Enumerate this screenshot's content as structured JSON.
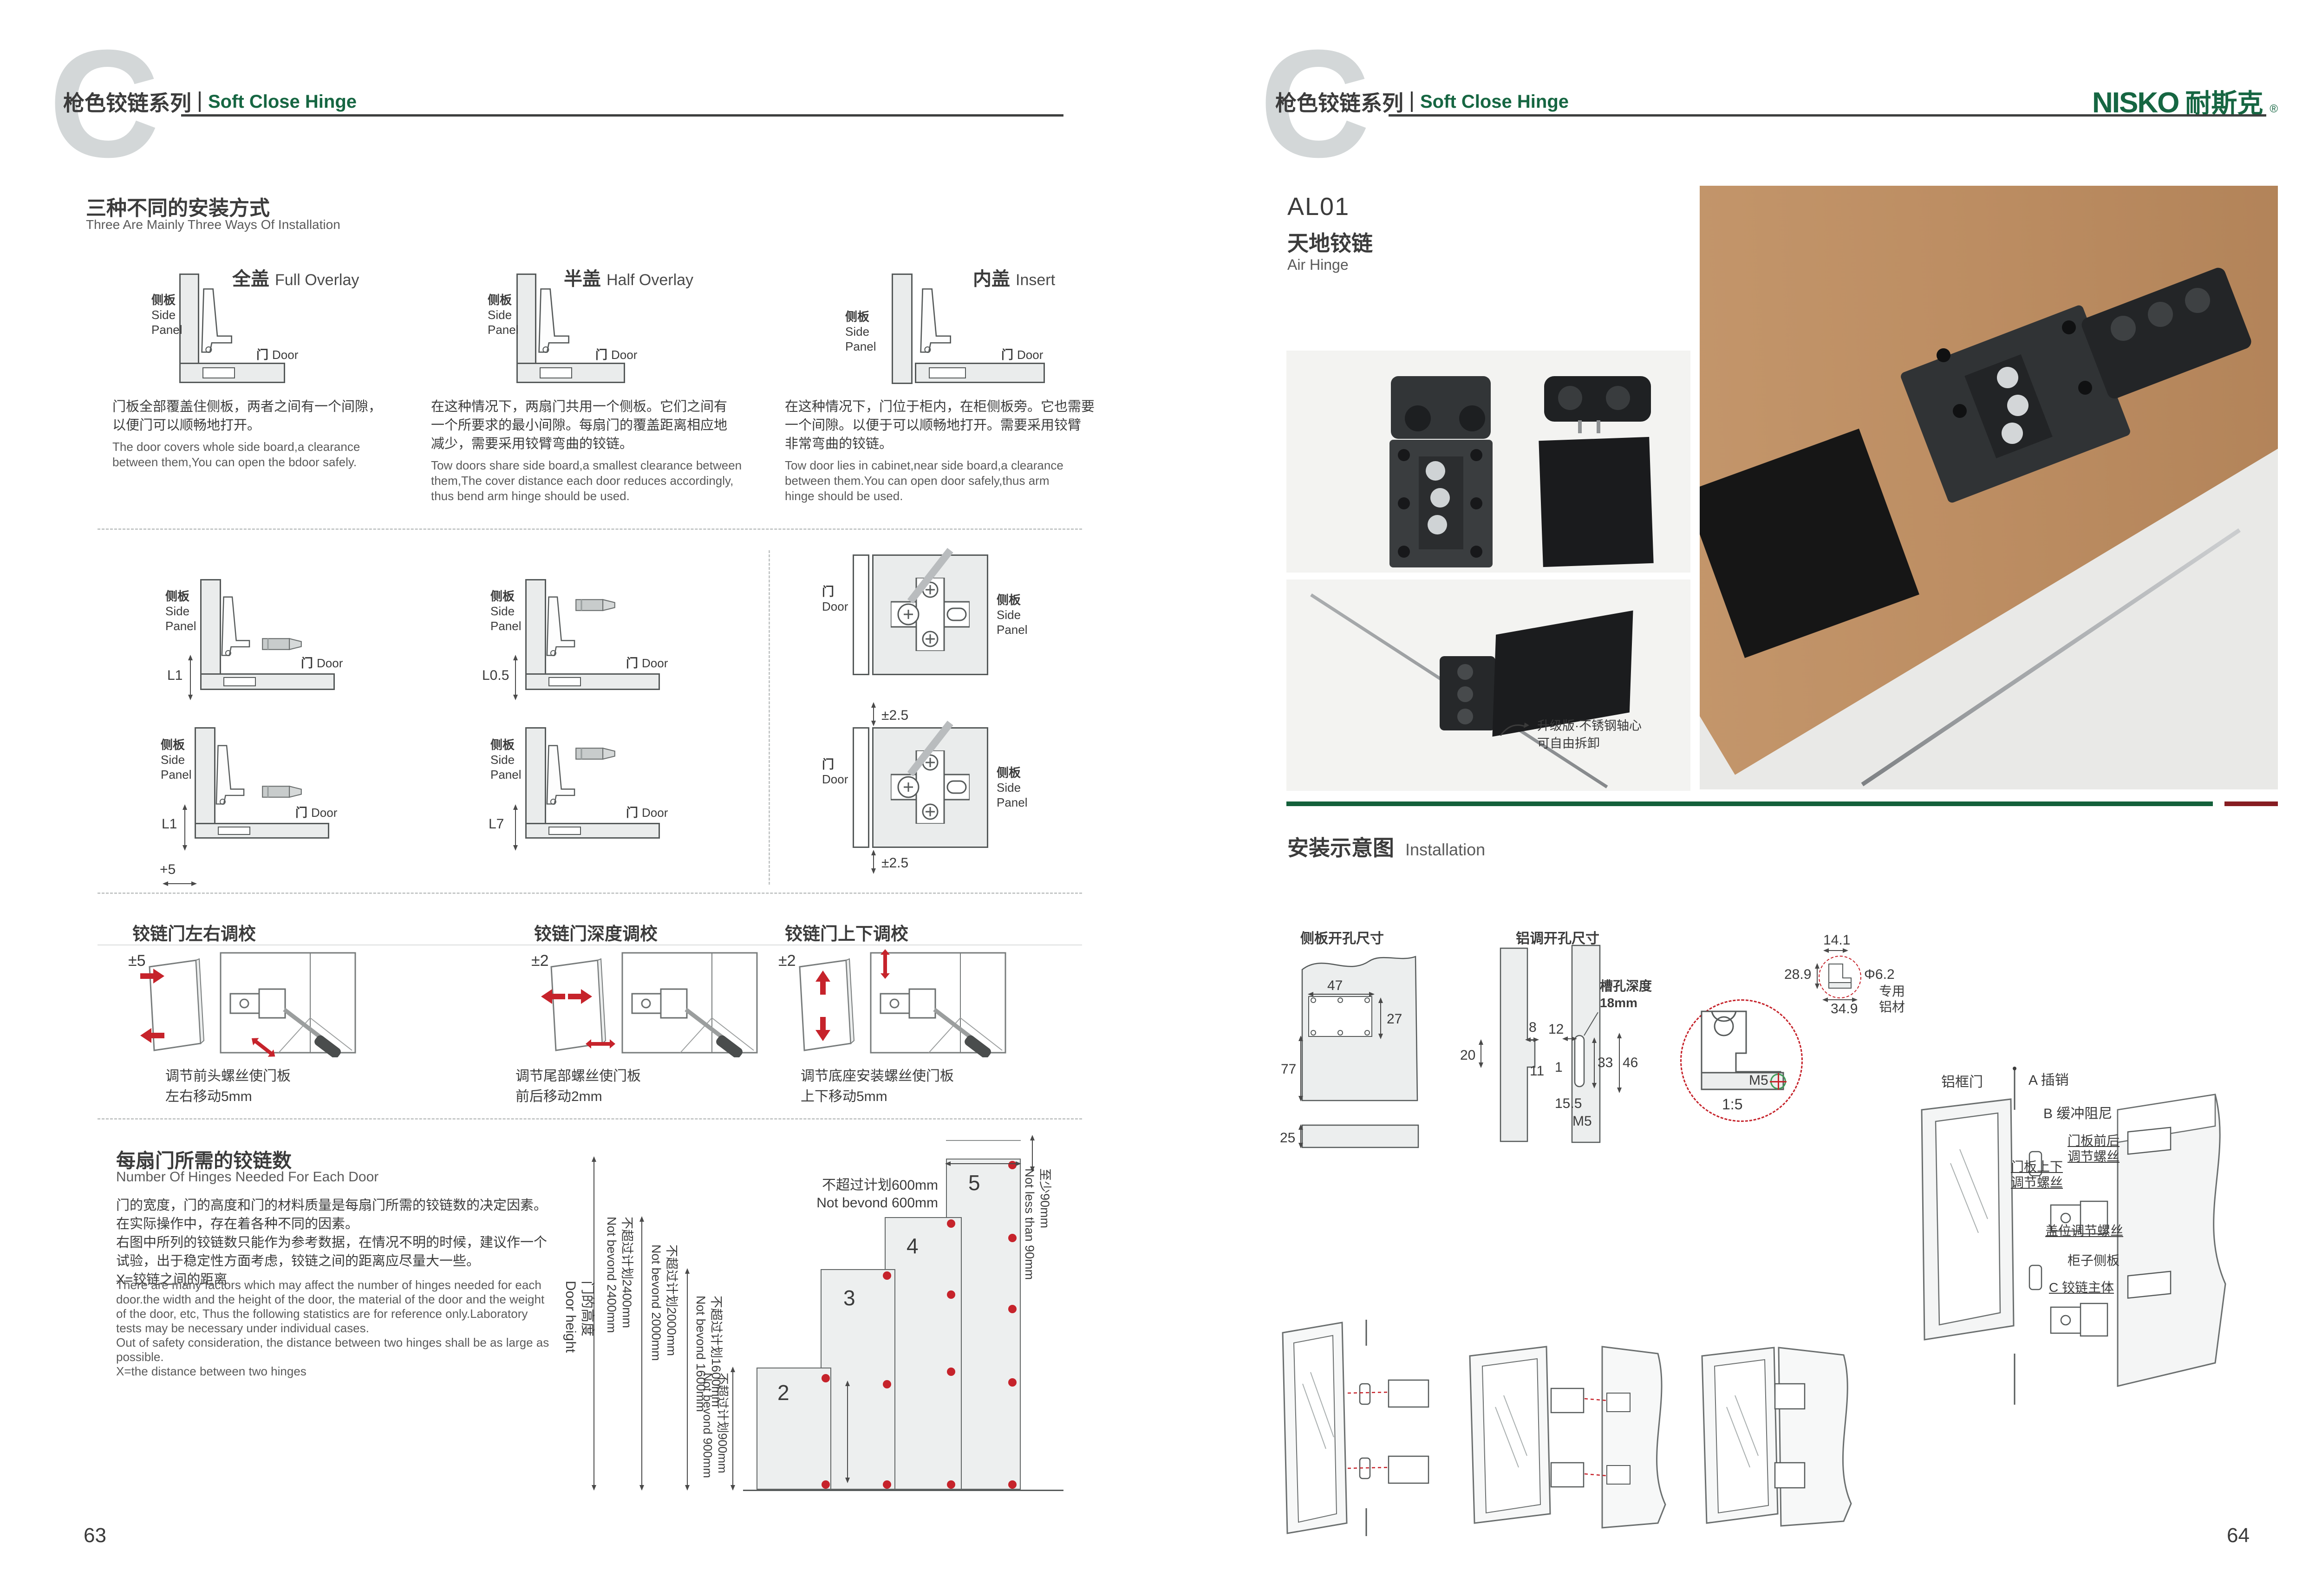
{
  "header": {
    "watermark": "C",
    "series_cn": "枪色铰链系列",
    "series_en": "Soft Close Hinge"
  },
  "brand": {
    "name": "NISKO",
    "cn": "耐斯克",
    "reg": "®"
  },
  "pages": {
    "left_no": "63",
    "right_no": "64"
  },
  "labels": {
    "side_panel_cn": "侧板",
    "side_panel_en1": "Side",
    "side_panel_en2": "Panel",
    "door_cn": "门",
    "door_en": "Door"
  },
  "install_ways": {
    "title_cn": "三种不同的安装方式",
    "title_en": "Three Are Mainly Three Ways Of Installation",
    "items": [
      {
        "name_cn": "全盖",
        "name_en": "Full Overlay",
        "desc_cn": "门板全部覆盖住侧板，两者之间有一个间隙，\n以便门可以顺畅地打开。",
        "desc_en": "The door covers whole side board,a clearance\nbetween them,You can open the bdoor safely."
      },
      {
        "name_cn": "半盖",
        "name_en": "Half Overlay",
        "desc_cn": "在这种情况下，两扇门共用一个侧板。它们之间有\n一个所要求的最小间隙。每扇门的覆盖距离相应地\n减少，需要采用铰臂弯曲的铰链。",
        "desc_en": "Tow doors share side board,a smallest clearance between\nthem,The cover distance each door reduces accordingly,\nthus bend arm hinge should be used."
      },
      {
        "name_cn": "内盖",
        "name_en": "Insert",
        "desc_cn": "在这种情况下，门位于柜内，在柜侧板旁。它也需要\n一个间隙。以便于可以顺畅地打开。需要采用铰臂\n非常弯曲的铰链。",
        "desc_en": "Tow door lies in cabinet,near side board,a clearance\nbetween them.You can open door safely,thus arm\nhinge should be used."
      }
    ]
  },
  "clearance": {
    "l1": "L1",
    "l05": "L0.5",
    "l1b": "L1",
    "plus5": "+5",
    "l7": "L7",
    "pm25_top": "±2.5",
    "pm25_bottom": "±2.5"
  },
  "adjustments": {
    "items": [
      {
        "title": "铰链门左右调校",
        "range": "±5",
        "caption": "调节前头螺丝使门板\n左右移动5mm"
      },
      {
        "title": "铰链门深度调校",
        "range": "±2",
        "caption": "调节尾部螺丝使门板\n前后移动2mm"
      },
      {
        "title": "铰链门上下调校",
        "range": "±2",
        "caption": "调节底座安装螺丝使门板\n上下移动5mm"
      }
    ]
  },
  "hinge_count": {
    "title_cn": "每扇门所需的铰链数",
    "title_en": "Number Of Hinges Needed For Each Door",
    "desc_cn": "门的宽度，门的高度和门的材料质量是每扇门所需的铰链数的决定因素。\n在实际操作中，存在着各种不同的因素。\n右图中所列的铰链数只能作为参考数据，在情况不明的时候，建议作一个\n试验，出于稳定性方面考虑，铰链之间的距离应尽量大一些。\nX=铰链之间的距离",
    "desc_en": "There are many factors which may affect the number of hinges needed for each\ndoor.the width and the height of the door, the material of the door and the weight\nof the door, etc, Thus the following statistics are for reference only.Laboratory\ntests may be necessary under individual cases.\nOut of safety consideration, the distance between two hinges shall be as large as\npossible.\nX=the distance between two hinges",
    "axis": {
      "door_height": "门的高度\nDoor height",
      "h2400": "不超过计划2400mm\nNot bevond 2400mm",
      "h2000": "不超过计划2000mm\nNot bevond 2000mm",
      "h1600": "不超过计划1600mm\nNot bevond 1600mm",
      "h900": "不超过计划900mm\nNot bevond 900mm",
      "w600": "不超过计划600mm\nNot bevond 600mm",
      "min90": "至少90mm\nNot less than 90mm"
    },
    "bars": [
      {
        "count": "2"
      },
      {
        "count": "3"
      },
      {
        "count": "4"
      },
      {
        "count": "5"
      }
    ]
  },
  "chart_data": {
    "type": "bar",
    "title": "每扇门所需的铰链数 Number Of Hinges Needed For Each Door",
    "categories": [
      "Not beyond 900mm",
      "Not beyond 1600mm",
      "Not beyond 2000mm",
      "Not beyond 2400mm"
    ],
    "values": [
      2,
      3,
      4,
      5
    ],
    "xlabel": "门的高度 Door height",
    "ylabel": "hinges per door",
    "notes": [
      "door width not beyond 600mm",
      "top hinge offset not less than 90mm",
      "X = distance between two hinges"
    ]
  },
  "product": {
    "code": "AL01",
    "name_cn": "天地铰链",
    "name_en": "Air Hinge",
    "photo_note": "升级版·不锈钢轴心\n可自由拆卸"
  },
  "installation": {
    "title_cn": "安装示意图",
    "title_en": "Installation",
    "side_hole_title": "侧板开孔尺寸",
    "alu_hole_title": "铝调开孔尺寸",
    "slot_depth": "槽孔深度\n18mm",
    "alu_profile": "专用\n铝材",
    "dims": {
      "d47": "47",
      "d27": "27",
      "d77": "77",
      "d25": "25",
      "d8": "8",
      "d20": "20",
      "d11": "11",
      "d12": "12",
      "d1": "1",
      "d33": "33",
      "d46": "46",
      "d155": "15.5",
      "m5": "M5",
      "scale": "1:5",
      "d141": "14.1",
      "d289": "28.9",
      "dia62": "Φ6.2",
      "d349": "34.9"
    },
    "callouts": {
      "frame_door": "铝框门",
      "a_pin": "A 插销",
      "b_damper": "B 缓冲阻尼",
      "fb_screw": "门板前后\n调节螺丝",
      "ud_screw": "门板上下\n调节螺丝",
      "overlay_screw": "盖位调节螺丝",
      "cabinet_side": "柜子侧板",
      "c_body": "C 铰链主体"
    }
  }
}
